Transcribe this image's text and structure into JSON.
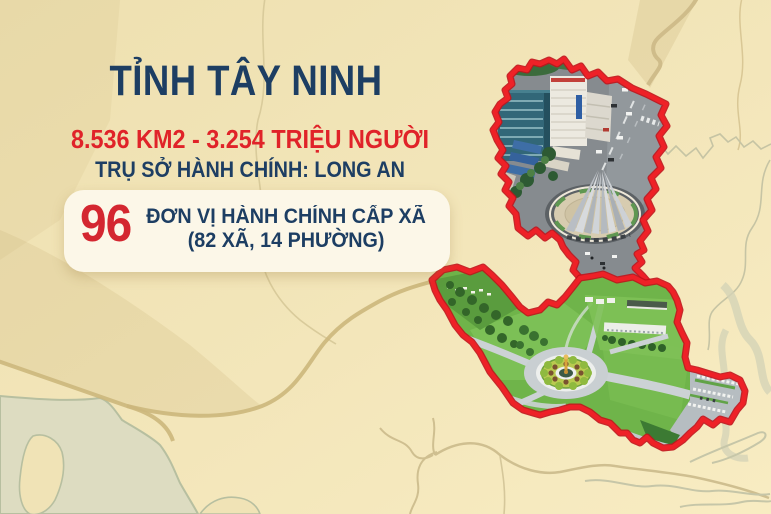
{
  "infographic": {
    "title": "TỈNH TÂY NINH",
    "stats_line": "8.536 KM2 - 3.254 TRIỆU NGƯỜI",
    "admin_line": "TRỤ SỞ HÀNH CHÍNH: LONG AN",
    "highlight": {
      "number": "96",
      "label_line1": "ĐƠN VỊ HÀNH CHÍNH CẤP XÃ",
      "label_line2": "(82 XÃ, 14 PHƯỜNG)"
    },
    "colors": {
      "navy": "#1d3e63",
      "red_text": "#e02329",
      "outline_red": "#ee2127",
      "background_beige": "#f2e5b8",
      "card_cream": "#fcf7e8"
    },
    "map": {
      "upper_photo": "city-aerial-monument-roundabout",
      "lower_photo": "green-landscape-fountain-roundabout"
    }
  }
}
